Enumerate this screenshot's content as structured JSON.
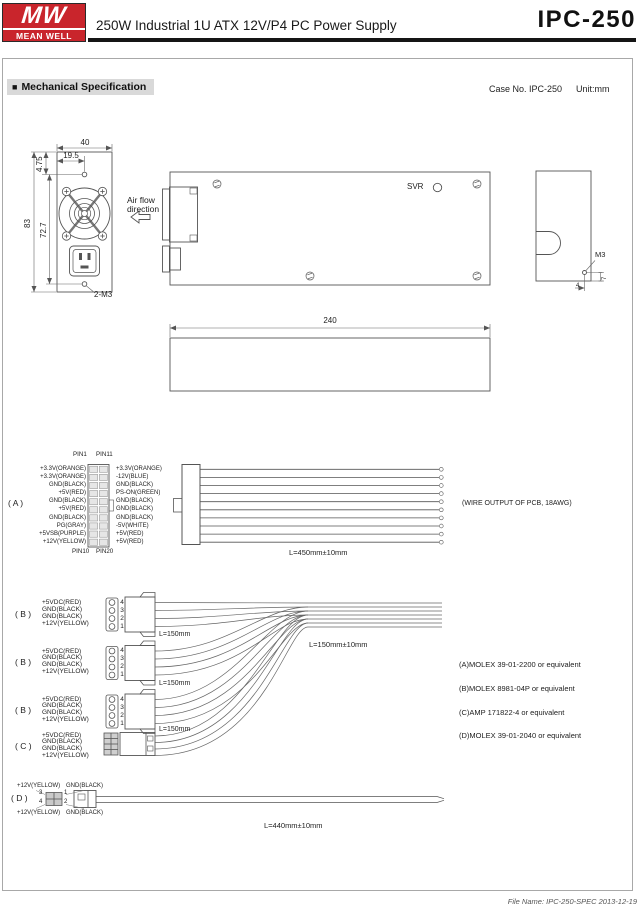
{
  "header": {
    "logo_mw": "MW",
    "logo_brand": "MEAN WELL",
    "title": "250W Industrial 1U ATX 12V/P4 PC Power Supply",
    "model": "IPC-250"
  },
  "section": {
    "bullet": "■",
    "title": "Mechanical Specification",
    "case_no": "Case No. IPC-250",
    "unit": "Unit:mm"
  },
  "drawing": {
    "front": {
      "dim_width": "40",
      "dim_inlet": "19.5",
      "dim_top": "4.75",
      "dim_height": "83",
      "dim_holes_span": "72.7",
      "holes_label": "2-M3"
    },
    "airflow_line1": "Air flow",
    "airflow_line2": "direction",
    "top": {
      "svr_label": "SVR"
    },
    "side": {
      "dim_length": "240"
    },
    "end": {
      "m3_label": "M3",
      "dim_v": "7",
      "dim_h": "4"
    }
  },
  "connector_a": {
    "row_label": "( A )",
    "pin1": "PIN1",
    "pin11": "PIN11",
    "pin10": "PIN10",
    "pin20": "PIN20",
    "left_pins": [
      "+3.3V(ORANGE)",
      "+3.3V(ORANGE)",
      "GND(BLACK)",
      "+5V(RED)",
      "GND(BLACK)",
      "+5V(RED)",
      "GND(BLACK)",
      "PG(GRAY)",
      "+5VSB(PURPLE)",
      "+12V(YELLOW)"
    ],
    "right_pins": [
      "+3.3V(ORANGE)",
      "-12V(BLUE)",
      "GND(BLACK)",
      "PS-ON(GREEN)",
      "GND(BLACK)",
      "GND(BLACK)",
      "GND(BLACK)",
      "-5V(WHITE)",
      "+5V(RED)",
      "+5V(RED)"
    ],
    "length_label": "L=450mm±10mm",
    "output_note": "(WIRE OUTPUT OF PCB, 18AWG)"
  },
  "rows_bc": {
    "b_label": "( B )",
    "c_label": "( C )",
    "pins": [
      "+5VDC(RED)",
      "GND(BLACK)",
      "GND(BLACK)",
      "+12V(YELLOW)"
    ],
    "pin_numbers": [
      "4",
      "3",
      "2",
      "1"
    ],
    "length_label": "L=150mm",
    "bundle_length_label": "L=150mm±10mm"
  },
  "notes": [
    "(A)MOLEX 39-01-2200 or equivalent",
    "(B)MOLEX 8981-04P or equivalent",
    "(C)AMP 171822-4 or equivalent",
    "(D)MOLEX 39-01-2040 or equivalent"
  ],
  "connector_d": {
    "row_label": "( D )",
    "top_left": "+12V(YELLOW)",
    "top_right": "GND(BLACK)",
    "bottom_left": "+12V(YELLOW)",
    "bottom_right": "GND(BLACK)",
    "p3": "3",
    "p4": "4",
    "p1": "1",
    "p2": "2",
    "length_label": "L=440mm±10mm"
  },
  "footer": {
    "text": "File Name: IPC-250-SPEC  2013-12-19"
  },
  "colors": {
    "brand_red": "#c9252c",
    "line": "#555555",
    "highlight": "#d9d9d9"
  }
}
